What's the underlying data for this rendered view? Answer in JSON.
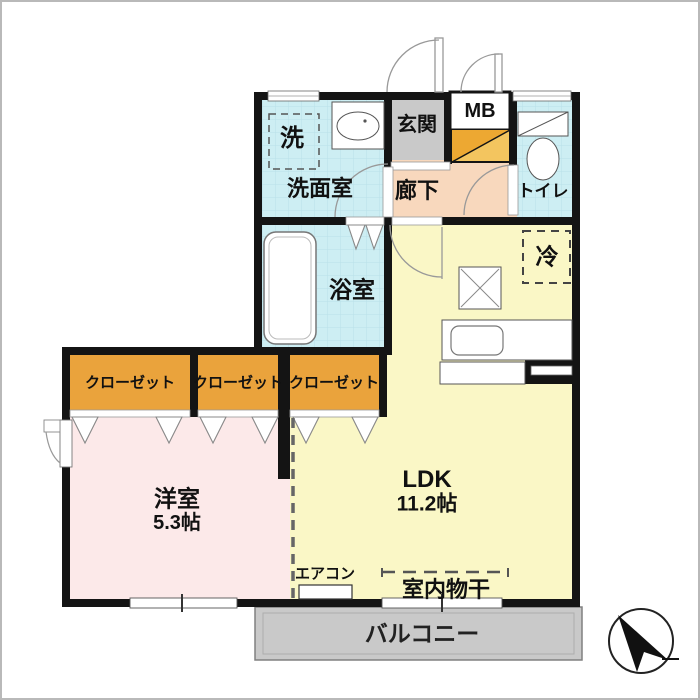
{
  "floorplan": {
    "labels": {
      "washer": "洗",
      "washroom": "洗面室",
      "entrance": "玄関",
      "meter_box": "MB",
      "toilet": "トイレ",
      "hallway": "廊下",
      "bathroom": "浴室",
      "refrigerator": "冷",
      "closet_1": "クローゼット",
      "closet_2": "クローゼット",
      "closet_3": "クローゼット",
      "western_room": "洋室",
      "western_room_size": "5.3帖",
      "ldk": "LDK",
      "ldk_size": "11.2帖",
      "air_conditioner": "エアコン",
      "indoor_laundry": "室内物干",
      "balcony": "バルコニー"
    },
    "icons": {
      "north_arrow": "compass-arrow-pointing-upper-left"
    },
    "colors": {
      "wall": "#141414",
      "ldk_fill": "#faf7c6",
      "western_room_fill": "#fce9e9",
      "wet_room_fill": "#cdeef3",
      "hallway_fill": "#f8d8bd",
      "entrance_fill": "#c9c9c9",
      "closet_fill": "#eaa33c",
      "shoe_cabinet_dark": "#eda832",
      "shoe_cabinet_light": "#f3c55f",
      "balcony_fill": "#c9c9c9"
    }
  }
}
